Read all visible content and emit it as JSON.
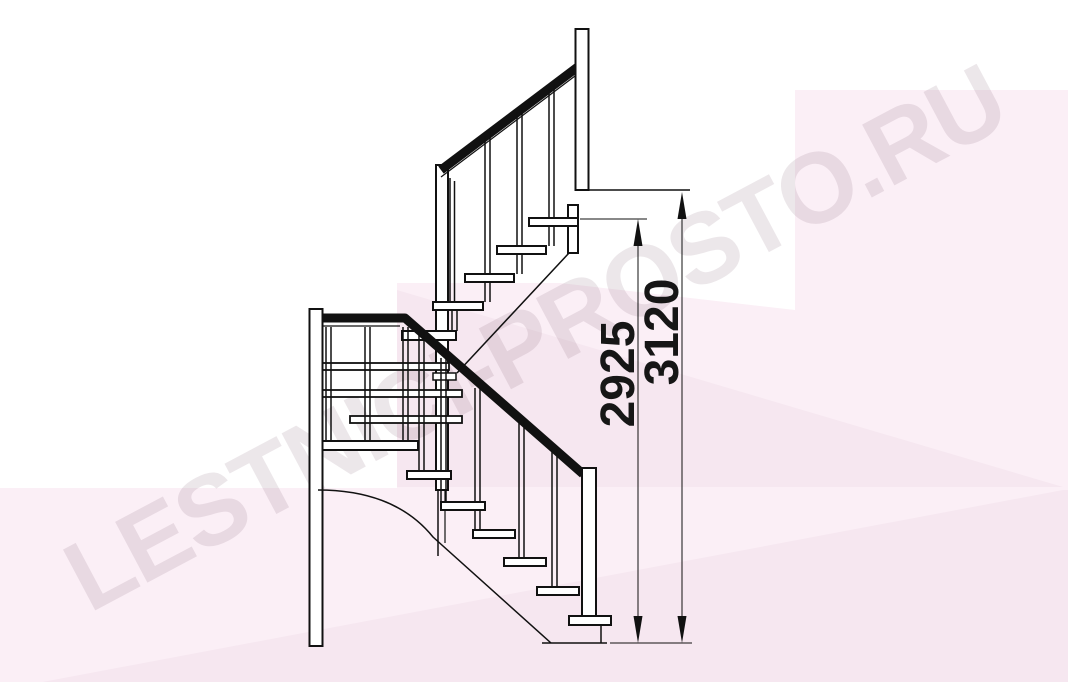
{
  "watermark": {
    "text": "LESTNICI-PROSTO.RU"
  },
  "dimensions": {
    "to_top_tread": {
      "value": "2925"
    },
    "total_rise": {
      "value": "3120"
    }
  },
  "drawing": {
    "subject": "staircase-side-elevation"
  },
  "colors": {
    "line": "#111111",
    "dimension_text": "#161616",
    "background": "#ffffff",
    "pink_light": "#fbeff6",
    "pink_dark": "#f6e7f0",
    "watermark": "rgba(95,55,85,0.12)"
  }
}
